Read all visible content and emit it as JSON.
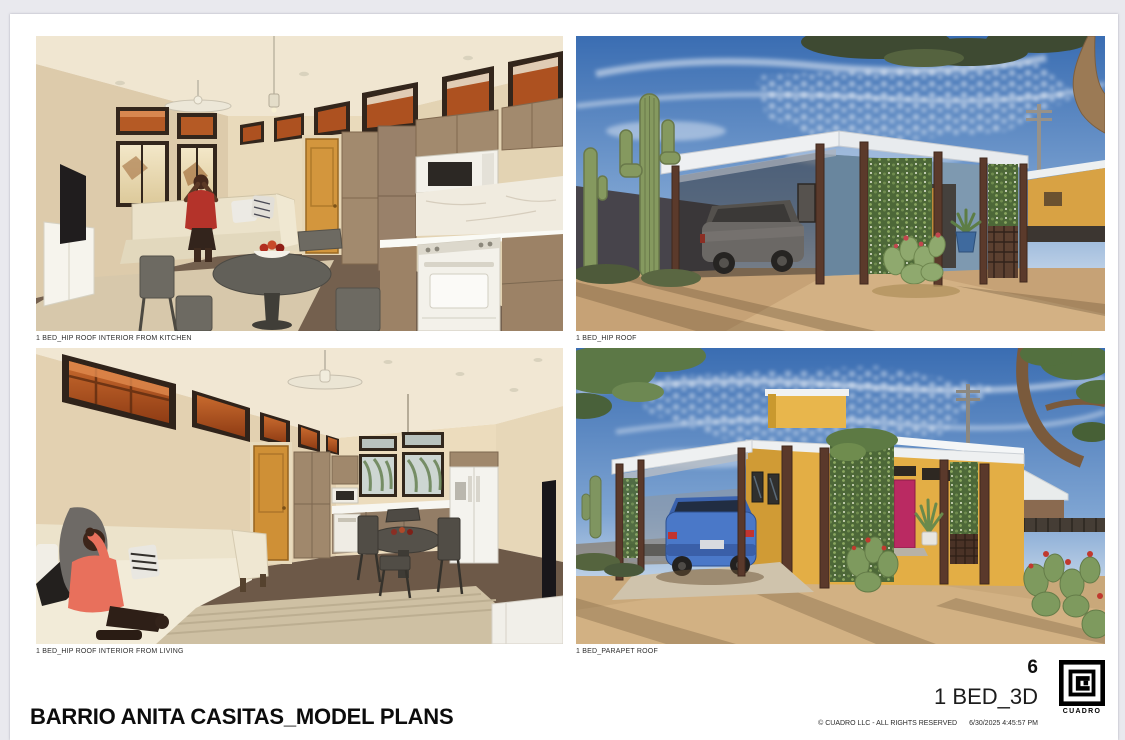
{
  "project_title": "BARRIO ANITA CASITAS_MODEL PLANS",
  "renders": [
    {
      "caption": "1 BED_HIP ROOF INTERIOR FROM KITCHEN",
      "alt": "interior rendering of living room and kitchen with orange door, sectional sofa and round dining table"
    },
    {
      "caption": "1 BED_HIP ROOF",
      "alt": "exterior rendering of blue hip-roof casita with carport, gray car, saguaro cacti and vine trellis"
    },
    {
      "caption": "1 BED_HIP ROOF INTERIOR FROM LIVING",
      "alt": "interior rendering from living room with person on sofa, orange door, kitchen and dining set"
    },
    {
      "caption": "1 BED_PARAPET ROOF",
      "alt": "exterior rendering of yellow parapet-roof casita with carport, blue car, magenta door and prickly pear cacti"
    }
  ],
  "title_block": {
    "sheet_number": "6",
    "sheet_name": "1 BED_3D",
    "copyright": "© CUADRO LLC - ALL RIGHTS RESERVED",
    "timestamp": "6/30/2025 4:45:57 PM",
    "logo_text": "CUADRO"
  },
  "colors": {
    "viewer_background": "#e9e9ee",
    "sheet": "#ffffff",
    "sky_blue": "#3a6db2",
    "casita_blue": "#7e99b0",
    "casita_yellow": "#e3ae45",
    "door_orange": "#d3963d",
    "door_magenta": "#ba2a62",
    "desert_ground": "#c6a276",
    "vine_green": "#4d6838",
    "interior_wall_beige": "#e3d1b1"
  }
}
